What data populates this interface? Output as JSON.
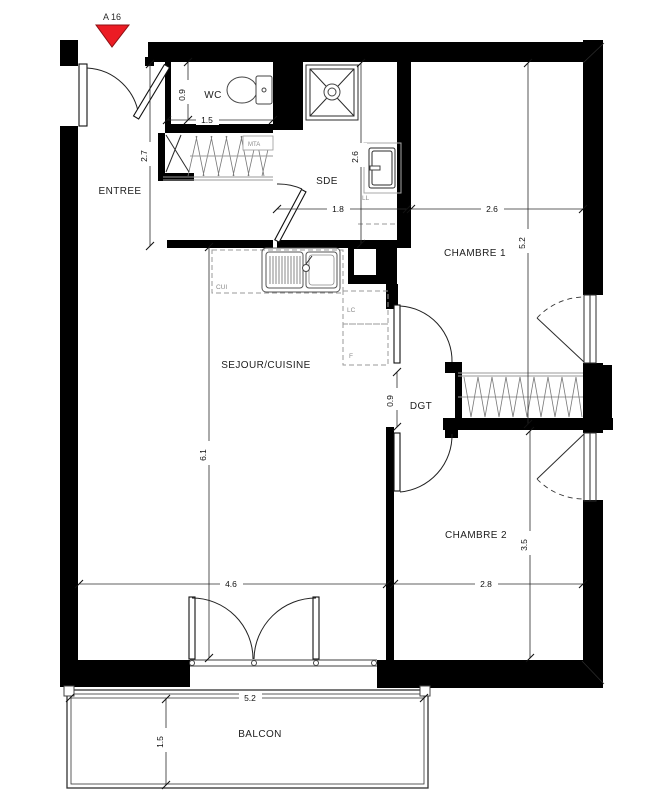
{
  "title_marker": {
    "label": "A 16"
  },
  "colors": {
    "wall": "#000000",
    "marker_red": "#ec1c24",
    "dim_text": "#111111",
    "gray_label": "#8a8a8a",
    "hatch": "#787878"
  },
  "rooms": {
    "entree": "ENTREE",
    "wc": "WC",
    "sde": "SDE",
    "chambre1": "CHAMBRE 1",
    "sejour": "SEJOUR/CUISINE",
    "dgt": "DGT",
    "chambre2": "CHAMBRE 2",
    "balcon": "BALCON"
  },
  "fixtures": {
    "kitchen_counter": "CUI",
    "dishwasher": "LC",
    "fridge": "F",
    "washer": "LL",
    "meter_box": "MTA"
  },
  "dimensions": {
    "wc_depth": "0.9",
    "wc_width": "1.5",
    "entree_height": "2.7",
    "sde_height": "2.6",
    "sde_width": "1.8",
    "chambre1_width": "2.6",
    "chambre1_height": "5.2",
    "sejour_height": "6.1",
    "dgt_width": "0.9",
    "chambre2_height": "3.5",
    "sejour_width": "4.6",
    "chambre2_width": "2.8",
    "balcon_width": "5.2",
    "balcon_depth": "1.5"
  }
}
